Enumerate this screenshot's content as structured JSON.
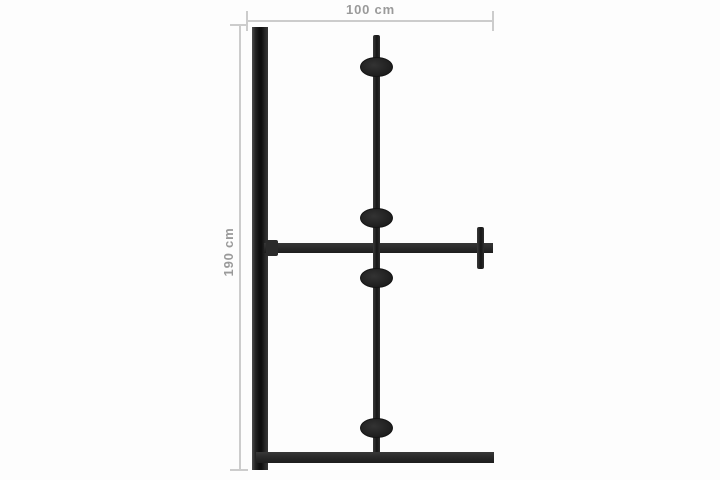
{
  "diagram": {
    "kind": "product-dimension-drawing",
    "dimensions": {
      "width": {
        "label": "100 cm",
        "value": 100,
        "unit": "cm",
        "orientation": "horizontal",
        "position": "top"
      },
      "height": {
        "label": "190 cm",
        "value": 190,
        "unit": "cm",
        "orientation": "vertical",
        "position": "left"
      }
    },
    "parts": {
      "wall_profile_bar": 1,
      "floor_bar": 1,
      "center_pole": 1,
      "hinge_connectors": 4,
      "crossbar": 1,
      "crossbar_end_handle": 1
    },
    "colors": {
      "frame": "#2b2b2b",
      "dimension_line": "#cccccc",
      "dimension_text": "#9a9a9a",
      "background": "#fdfdfd"
    }
  }
}
